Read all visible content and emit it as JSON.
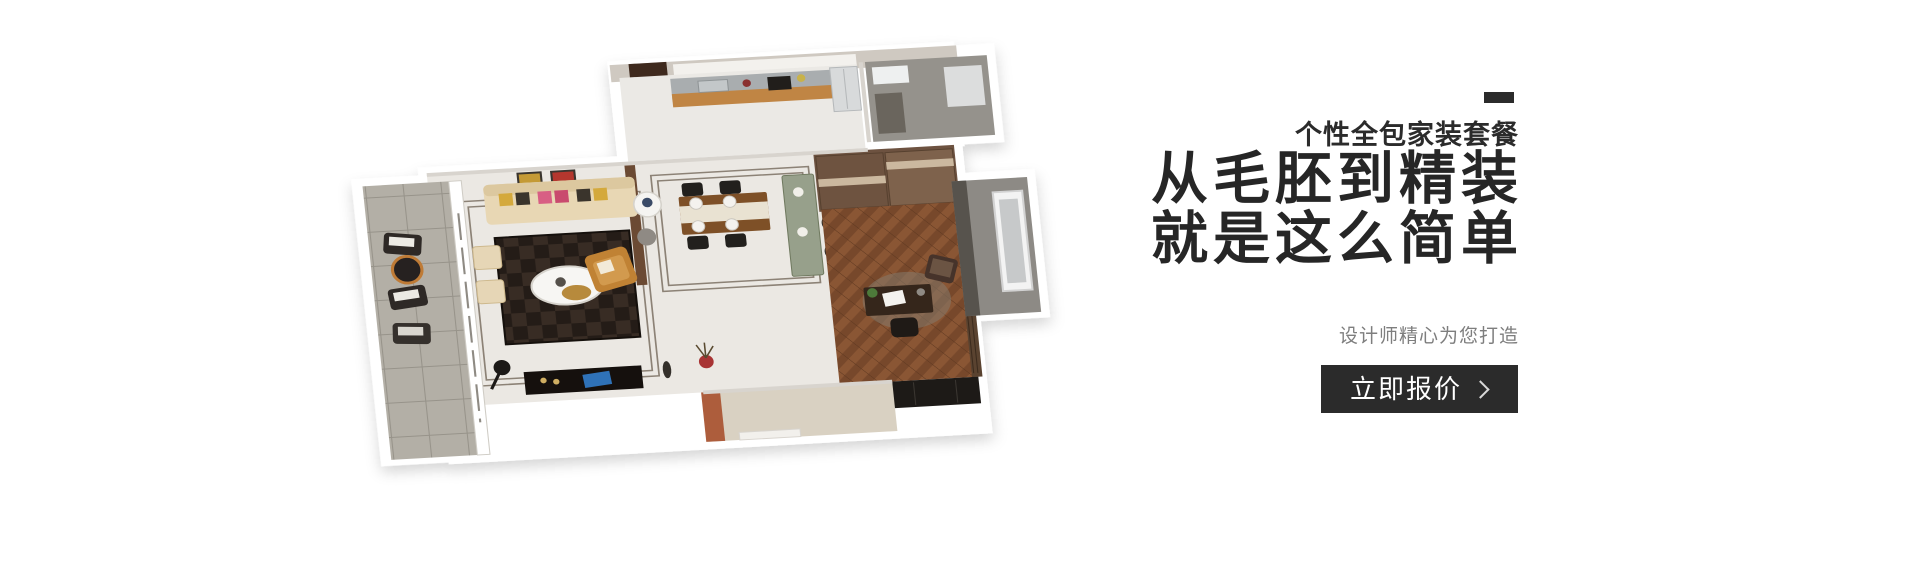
{
  "floorplan": {
    "alt": "3D isometric rendering of a furnished apartment floor plan with balcony, living room, dining room, kitchen, bathroom, study and entry hall"
  },
  "promo": {
    "eyebrow": "个性全包家装套餐",
    "title_line1": "从毛胚到精装",
    "title_line2": "就是这么简单",
    "subtitle": "设计师精心为您打造",
    "cta": {
      "label": "立即报价",
      "icon": "chevron-right"
    },
    "colors": {
      "accent_dash": "#2b2b2b",
      "heading_text": "#262626",
      "subtitle_text": "#7e7e7e",
      "button_background": "#2b2b2b",
      "button_text": "#ffffff"
    }
  }
}
